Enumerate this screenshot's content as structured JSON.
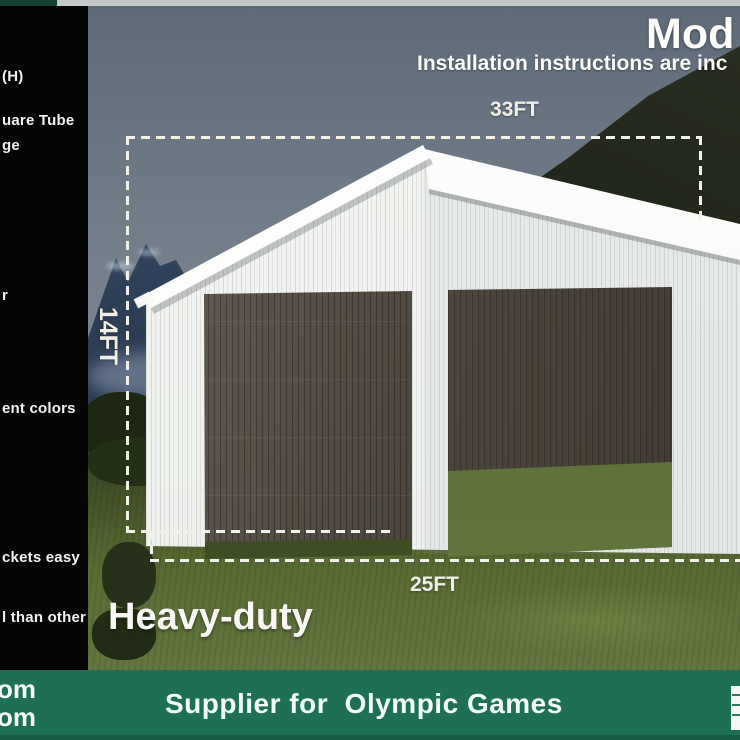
{
  "sidebar": {
    "lines": [
      "(H)",
      "uare Tube",
      "ge",
      "r",
      "ent colors",
      "ckets easy",
      "l than other"
    ]
  },
  "overlay": {
    "model_heading": "Mod",
    "instructions_line": "Installation instructions are inc",
    "width_label": "33FT",
    "height_label": "14FT",
    "depth_label": "25FT",
    "duty_label": "Heavy-duty"
  },
  "banner": {
    "cut_lines": [
      "om",
      "om"
    ],
    "title": "Supplier for  Olympic Games"
  },
  "colors": {
    "banner_green": "#1f6f56",
    "sidebar_black": "#050505",
    "dash_line": "#f2f1e8",
    "building_white": "#f4f5f2"
  }
}
